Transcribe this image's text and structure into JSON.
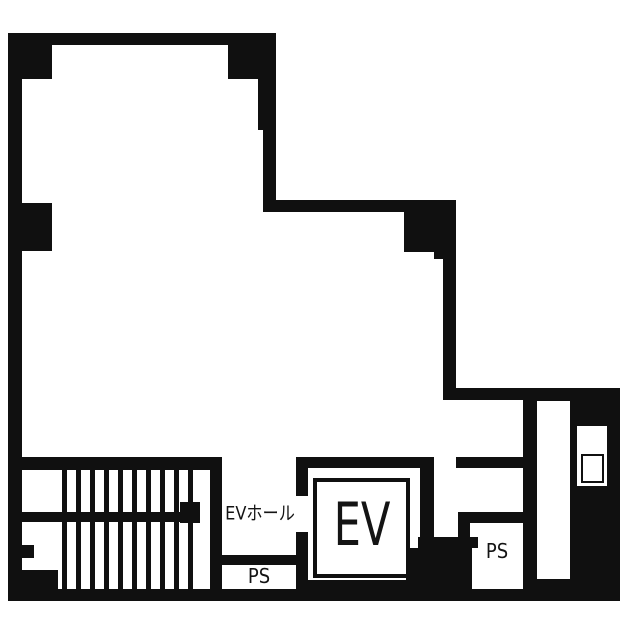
{
  "floor_plan": {
    "labels": {
      "ev_hall": "EVホール",
      "elevator_car": "EV",
      "pipe_shaft_left": "PS",
      "pipe_shaft_right": "PS"
    },
    "colors": {
      "wall": "#101010",
      "floor": "#ffffff"
    }
  }
}
